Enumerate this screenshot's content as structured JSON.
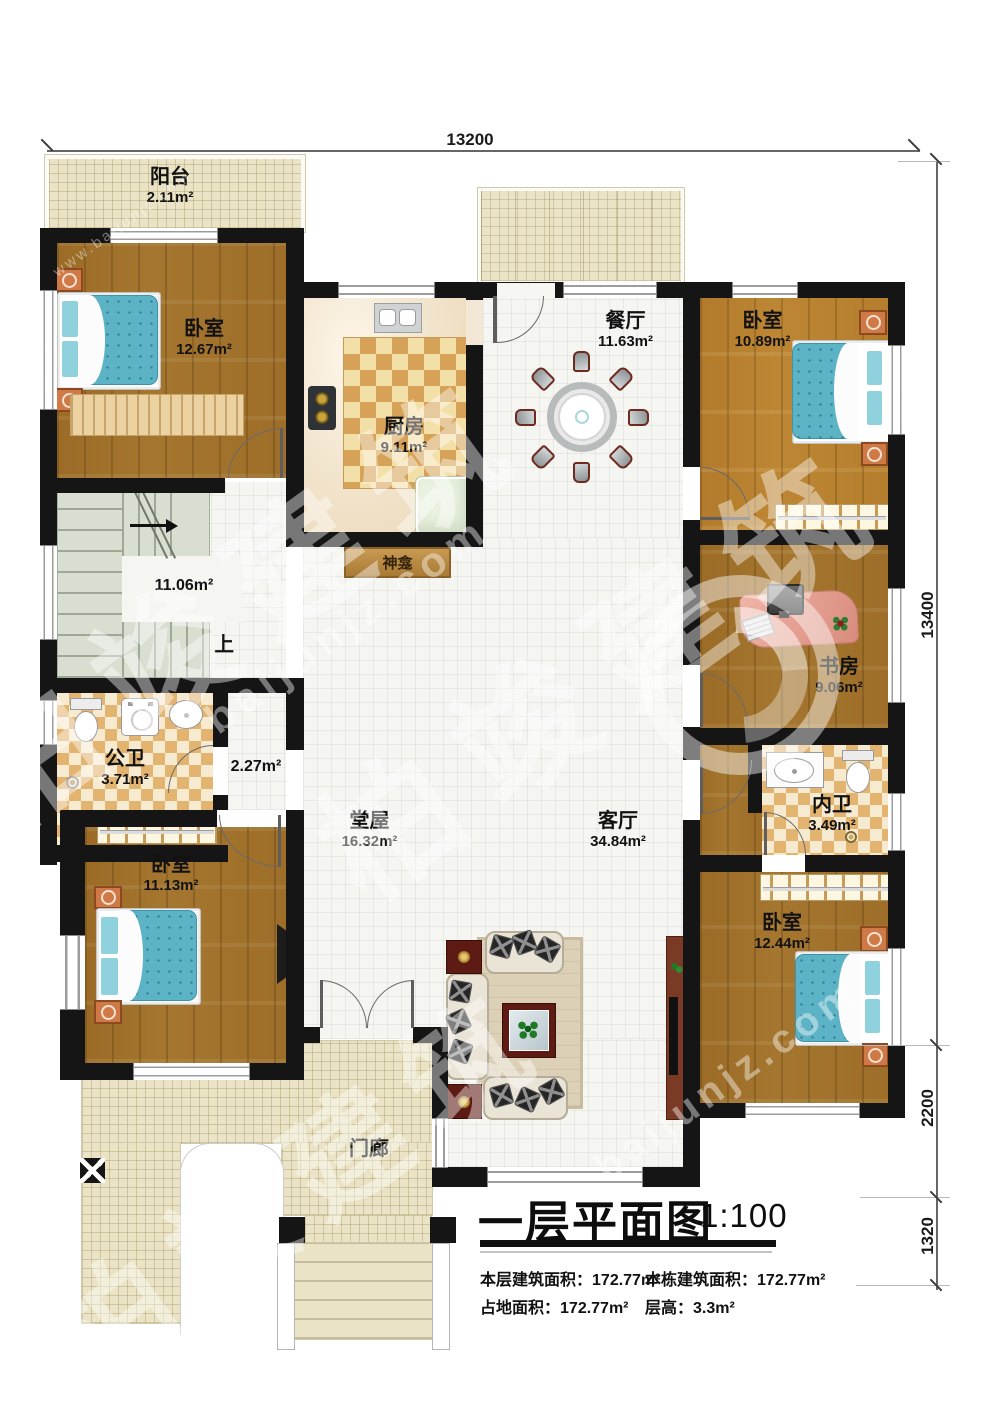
{
  "title": {
    "text": "一层平面图",
    "scale": "1:100"
  },
  "stats": {
    "floor_area_label": "本层建筑面积：",
    "floor_area_value": "172.77m²",
    "total_area_label": "本栋建筑面积：",
    "total_area_value": "172.77m²",
    "footprint_label": "占地面积：",
    "footprint_value": "172.77m²",
    "storey_height_label": "层高：",
    "storey_height_value": "3.3m²"
  },
  "dimensions": {
    "top": "13200",
    "right_main": "13400",
    "right_mid": "2200",
    "right_low": "1320"
  },
  "rooms": {
    "balcony": {
      "name": "阳台",
      "area": "2.11m²"
    },
    "bedroom_nw": {
      "name": "卧室",
      "area": "12.67m²"
    },
    "kitchen": {
      "name": "厨房",
      "area": "9.11m²"
    },
    "dining": {
      "name": "餐厅",
      "area": "11.63m²"
    },
    "bedroom_ne": {
      "name": "卧室",
      "area": "10.89m²"
    },
    "study": {
      "name": "书房",
      "area": "9.06m²"
    },
    "public_bath": {
      "name": "公卫",
      "area": "3.71m²"
    },
    "hall": {
      "name": "堂屋",
      "area": "16.32m²"
    },
    "living": {
      "name": "客厅",
      "area": "34.84m²"
    },
    "inner_bath": {
      "name": "内卫",
      "area": "3.49m²"
    },
    "bedroom_sw": {
      "name": "卧室",
      "area": "11.13m²"
    },
    "bedroom_se": {
      "name": "卧室",
      "area": "12.44m²"
    },
    "porch": {
      "name": "门廊"
    },
    "shrine": {
      "name": "神龛"
    }
  },
  "stair": {
    "area": "11.06m²",
    "up": "上"
  },
  "corridor": {
    "area": "2.27m²"
  },
  "watermark": {
    "brand": "柏竣建筑",
    "domain": "baijunjz.com",
    "url": "www.baijunjz.com"
  }
}
